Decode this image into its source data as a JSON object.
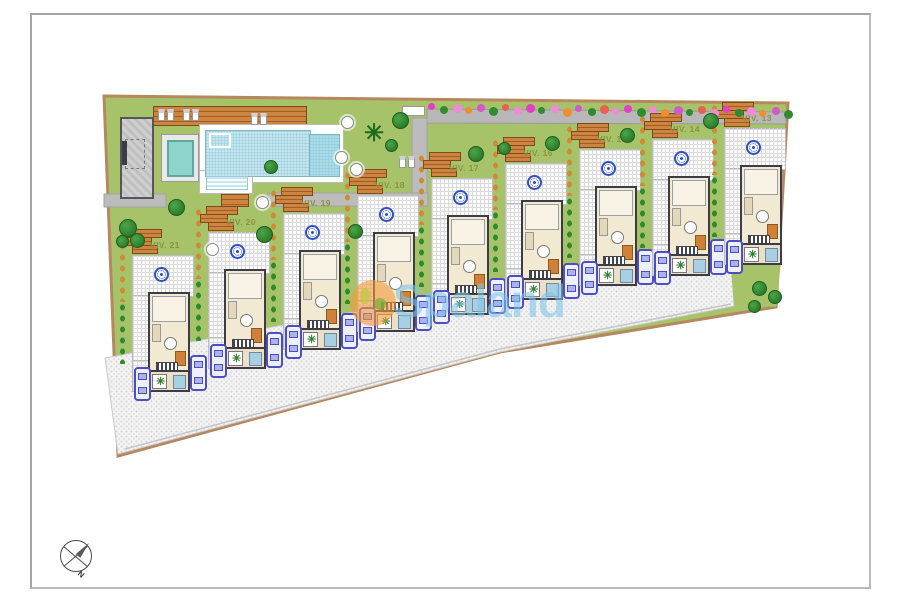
{
  "watermark": {
    "text": "Spaland",
    "logo_color": "rgba(242,153,60,0.62)",
    "text_color": "rgba(125,195,235,0.58)"
  },
  "compass": {
    "label": "N"
  },
  "site": {
    "grass_color": "#a7c36a",
    "border_color": "#b5885f",
    "road_color": "#b8b8b8",
    "path_color": "#bcbcbc",
    "outline": [
      [
        104,
        96
      ],
      [
        788,
        103
      ],
      [
        776,
        307
      ],
      [
        500,
        352
      ],
      [
        118,
        456
      ]
    ],
    "pavement": [
      [
        105,
        358
      ],
      [
        730,
        242
      ],
      [
        734,
        306
      ],
      [
        500,
        352
      ],
      [
        118,
        454
      ]
    ],
    "green_patch": [
      [
        731,
        268
      ],
      [
        781,
        262
      ],
      [
        776,
        307
      ],
      [
        734,
        305
      ]
    ],
    "road": [
      [
        427,
        109
      ],
      [
        786,
        112
      ],
      [
        786,
        124
      ],
      [
        427,
        123
      ]
    ],
    "curb": [
      [
        125,
        449
      ],
      [
        500,
        349
      ],
      [
        731,
        304
      ]
    ],
    "vpath": {
      "x": 412,
      "y": 118,
      "w": 15,
      "h": 78
    },
    "hpaths": [
      {
        "x": 104,
        "y": 194,
        "w": 62,
        "h": 13
      },
      {
        "x": 268,
        "y": 193,
        "w": 160,
        "h": 13
      }
    ]
  },
  "villas": [
    {
      "label": "VIV. 21",
      "x": 132,
      "y": 255,
      "car2": true
    },
    {
      "label": "VIV. 20",
      "x": 208,
      "y": 232,
      "car2": true
    },
    {
      "label": "VIV. 19",
      "x": 283,
      "y": 213,
      "car2": true
    },
    {
      "label": "VIV. 18",
      "x": 357,
      "y": 195,
      "car2": true
    },
    {
      "label": "VIV. 17",
      "x": 431,
      "y": 178,
      "car2": true
    },
    {
      "label": "VIV. 16",
      "x": 505,
      "y": 163,
      "car2": true
    },
    {
      "label": "VIV. 15",
      "x": 579,
      "y": 149,
      "car2": true
    },
    {
      "label": "VIV. 14",
      "x": 652,
      "y": 139,
      "car2": true
    },
    {
      "label": "VIV. 13",
      "x": 724,
      "y": 128,
      "car2": false
    }
  ],
  "pool_area": {
    "water_color": "#c3e7f0",
    "deep_color": "#a9dde9",
    "kid_pool_color": "#8fd4cc"
  },
  "flowers": {
    "x_start": 428,
    "x_end": 784,
    "count": 30,
    "colors": [
      "#e23ec8",
      "#2e8b2e",
      "#f08ad8",
      "#ef8d2f",
      "#d457c9",
      "#2e8b2e",
      "#e8604f",
      "#f08ad8"
    ]
  },
  "trees": [
    [
      119,
      219,
      16
    ],
    [
      168,
      199,
      15
    ],
    [
      130,
      233,
      13
    ],
    [
      116,
      235,
      11
    ],
    [
      256,
      226,
      15
    ],
    [
      348,
      224,
      13
    ],
    [
      392,
      112,
      15
    ],
    [
      468,
      146,
      14
    ],
    [
      498,
      142,
      11
    ],
    [
      545,
      136,
      13
    ],
    [
      620,
      128,
      13
    ],
    [
      703,
      113,
      14
    ],
    [
      752,
      281,
      13
    ],
    [
      768,
      290,
      12
    ],
    [
      748,
      300,
      11
    ],
    [
      264,
      160,
      12
    ]
  ],
  "icons": {
    "palm": "✳",
    "shrub": "✳"
  }
}
